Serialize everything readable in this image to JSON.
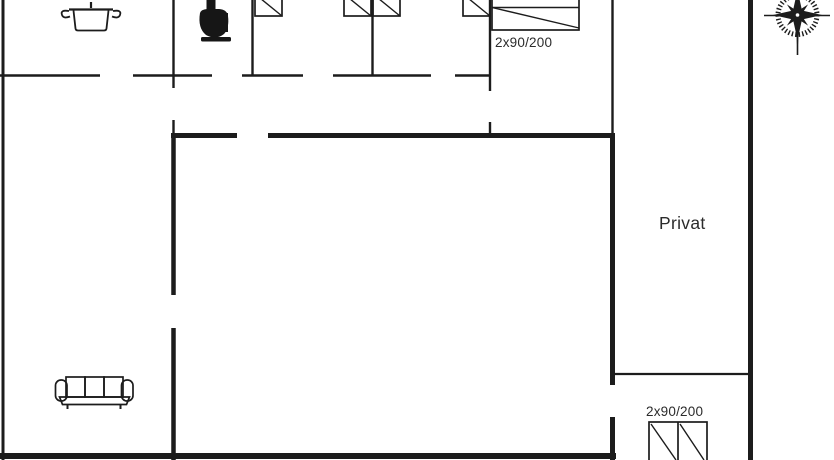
{
  "floorplan": {
    "background_color": "#ffffff",
    "line_color": "#1c1c1c",
    "labels": {
      "room_private": "Privat",
      "bed_size_top": "2x90/200",
      "bed_size_bottom": "2x90/200"
    },
    "icons": [
      "cooking-pot-icon",
      "toilet-icon",
      "single-bed-symbol",
      "double-bed-symbol",
      "bunk-bed-symbol",
      "sofa-icon",
      "compass-rose-icon"
    ]
  }
}
